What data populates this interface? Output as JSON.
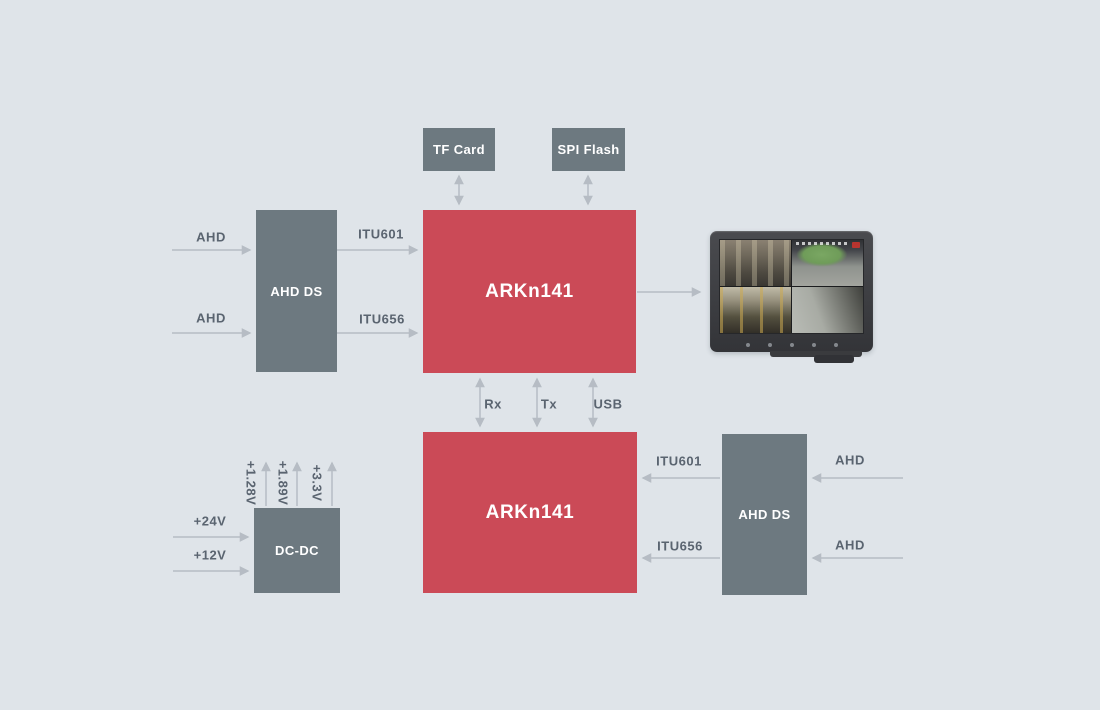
{
  "colors": {
    "bg": "#dfe4e9",
    "block_gray": "#6d7980",
    "block_red": "#cb4a57",
    "arrow": "#b6bcc4",
    "label_text": "#5a6470",
    "block_text": "#ffffff"
  },
  "blocks": {
    "tf_card": "TF Card",
    "spi_flash": "SPI Flash",
    "ahd_ds_top": "AHD DS",
    "arkn141_top": "ARKn141",
    "arkn141_bottom": "ARKn141",
    "ahd_ds_bottom": "AHD DS",
    "dc_dc": "DC-DC"
  },
  "wire_labels": {
    "ahd_top_1": "AHD",
    "ahd_top_2": "AHD",
    "itu601_top": "ITU601",
    "itu656_top": "ITU656",
    "rx": "Rx",
    "tx": "Tx",
    "usb": "USB",
    "itu601_bottom": "ITU601",
    "itu656_bottom": "ITU656",
    "ahd_bottom_1": "AHD",
    "ahd_bottom_2": "AHD",
    "v24": "+24V",
    "v12": "+12V",
    "v1_28": "+1.28V",
    "v1_89": "+1.89V",
    "v3_3": "+3.3V"
  }
}
